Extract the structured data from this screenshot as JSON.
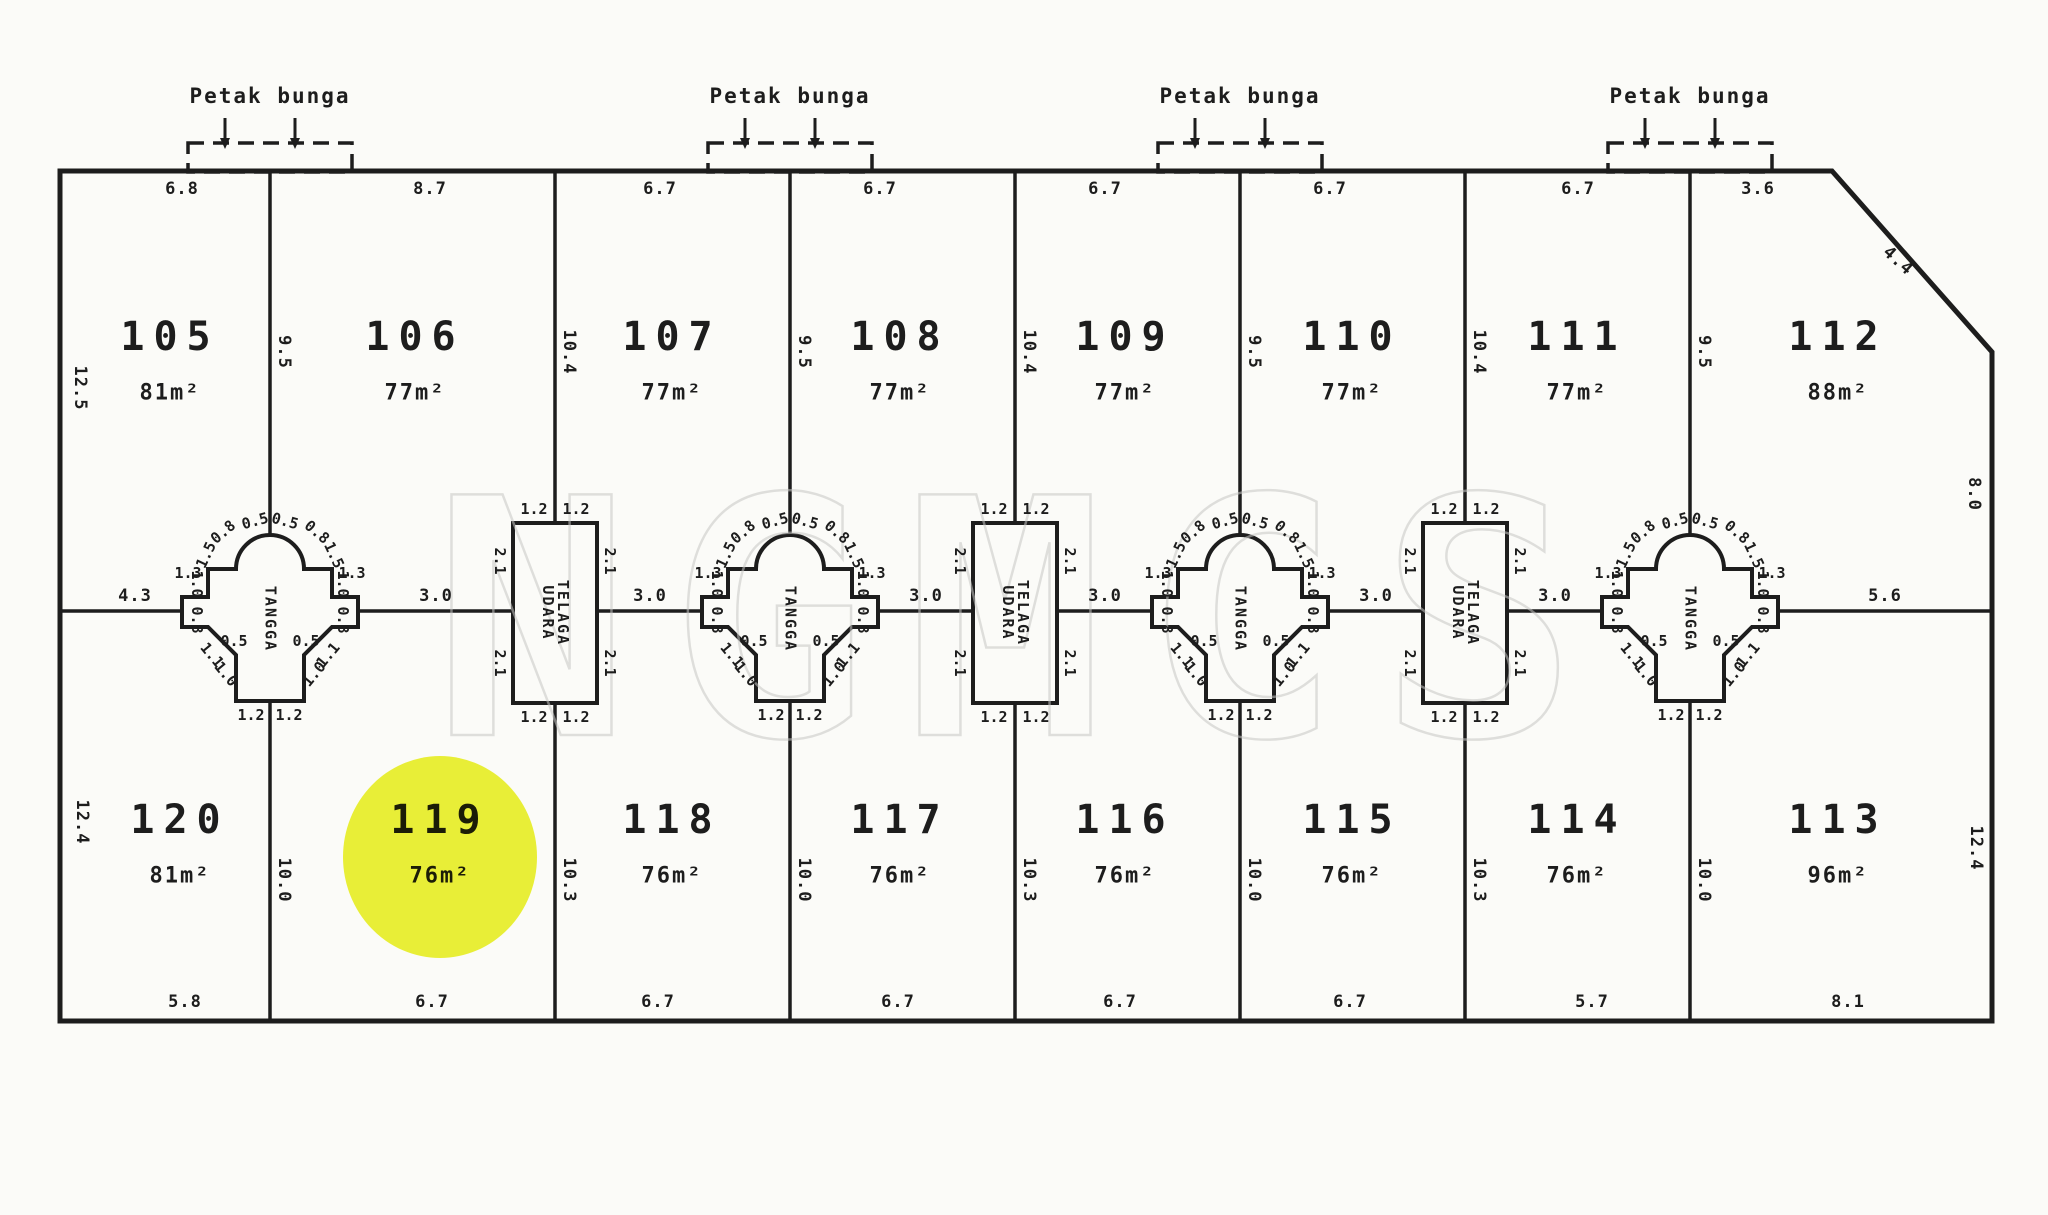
{
  "title": "Site lot plan (scanned)",
  "watermark_text": "NGMCS",
  "colors": {
    "ink": "#1d1d1d",
    "paper": "#fbfbf8",
    "watermark": "#c7c7c5",
    "highlight": "#e7ef00"
  },
  "plan": {
    "outline_points": "60,171 1832,171 1992,352 1992,1021 60,1021",
    "top_y": 171,
    "bottom_y": 1021,
    "mid_line_y": 611,
    "left_x": 60,
    "right_x": 1992,
    "divider_xs": [
      270,
      555,
      790,
      1015,
      1240,
      1465,
      1690
    ]
  },
  "flower_beds": {
    "label": "Petak bunga",
    "xs": [
      270,
      790,
      1240,
      1690
    ],
    "label_y": 96,
    "box_top": 143,
    "box_height": 29,
    "box_half_width": 82
  },
  "stairs": {
    "label": "TANGGA",
    "xs": [
      270,
      790,
      1240,
      1690
    ]
  },
  "air_wells": {
    "label_line1": "TELAGA",
    "label_line2": "UDARA",
    "xs": [
      555,
      1015,
      1465
    ]
  },
  "lots": {
    "top": [
      {
        "no": "105",
        "area": "81m²",
        "cx": 170
      },
      {
        "no": "106",
        "area": "77m²",
        "cx": 415
      },
      {
        "no": "107",
        "area": "77m²",
        "cx": 672
      },
      {
        "no": "108",
        "area": "77m²",
        "cx": 900
      },
      {
        "no": "109",
        "area": "77m²",
        "cx": 1125
      },
      {
        "no": "110",
        "area": "77m²",
        "cx": 1352
      },
      {
        "no": "111",
        "area": "77m²",
        "cx": 1577
      },
      {
        "no": "112",
        "area": "88m²",
        "cx": 1838
      }
    ],
    "bottom": [
      {
        "no": "120",
        "area": "81m²",
        "cx": 180
      },
      {
        "no": "119",
        "area": "76m²",
        "cx": 440,
        "highlighted": true
      },
      {
        "no": "118",
        "area": "76m²",
        "cx": 672
      },
      {
        "no": "117",
        "area": "76m²",
        "cx": 900
      },
      {
        "no": "116",
        "area": "76m²",
        "cx": 1125
      },
      {
        "no": "115",
        "area": "76m²",
        "cx": 1352
      },
      {
        "no": "114",
        "area": "76m²",
        "cx": 1577
      },
      {
        "no": "113",
        "area": "96m²",
        "cx": 1838
      }
    ],
    "top_no_y": 337,
    "top_area_y": 393,
    "bottom_no_y": 820,
    "bottom_area_y": 876
  },
  "dims": {
    "top_edge_y": 189,
    "top_edge": [
      {
        "t": "6.8",
        "x": 182
      },
      {
        "t": "8.7",
        "x": 430
      },
      {
        "t": "6.7",
        "x": 660
      },
      {
        "t": "6.7",
        "x": 880
      },
      {
        "t": "6.7",
        "x": 1105
      },
      {
        "t": "6.7",
        "x": 1330
      },
      {
        "t": "6.7",
        "x": 1578
      },
      {
        "t": "3.6",
        "x": 1758
      }
    ],
    "bottom_edge_y": 1002,
    "bottom_edge": [
      {
        "t": "5.8",
        "x": 185
      },
      {
        "t": "6.7",
        "x": 432
      },
      {
        "t": "6.7",
        "x": 658
      },
      {
        "t": "6.7",
        "x": 898
      },
      {
        "t": "6.7",
        "x": 1120
      },
      {
        "t": "6.7",
        "x": 1350
      },
      {
        "t": "5.7",
        "x": 1592
      },
      {
        "t": "8.1",
        "x": 1848
      }
    ],
    "upper_divider_y": 352,
    "upper_dividers": [
      "9.5",
      "10.4",
      "9.5",
      "10.4",
      "9.5",
      "10.4",
      "9.5"
    ],
    "lower_divider_y": 880,
    "lower_dividers": [
      "10.0",
      "10.3",
      "10.0",
      "10.3",
      "10.0",
      "10.3",
      "10.0"
    ],
    "mid_line_y": 596,
    "mid_line": [
      {
        "t": "4.3",
        "x": 135
      },
      {
        "t": "3.0",
        "x": 436
      },
      {
        "t": "3.0",
        "x": 650
      },
      {
        "t": "3.0",
        "x": 926
      },
      {
        "t": "3.0",
        "x": 1105
      },
      {
        "t": "3.0",
        "x": 1376
      },
      {
        "t": "3.0",
        "x": 1555
      },
      {
        "t": "5.6",
        "x": 1885
      }
    ],
    "edges": [
      {
        "t": "12.5",
        "x": 80,
        "y": 388,
        "r": 90
      },
      {
        "t": "12.4",
        "x": 82,
        "y": 822,
        "r": 90
      },
      {
        "t": "4.4",
        "x": 1898,
        "y": 261,
        "r": 42
      },
      {
        "t": "8.0",
        "x": 1974,
        "y": 494,
        "r": 90
      },
      {
        "t": "12.4",
        "x": 1976,
        "y": 848,
        "r": 90
      }
    ]
  },
  "cross_dims": [
    {
      "t": "0.5",
      "dx": -15,
      "dy": -90,
      "r": -15
    },
    {
      "t": "0.5",
      "dx": 15,
      "dy": -90,
      "r": 15
    },
    {
      "t": "0.8",
      "dx": -47,
      "dy": -79,
      "r": -40
    },
    {
      "t": "0.8",
      "dx": 47,
      "dy": -79,
      "r": 40
    },
    {
      "t": "1.5",
      "dx": -64,
      "dy": -56,
      "r": -65
    },
    {
      "t": "1.5",
      "dx": 64,
      "dy": -56,
      "r": 65
    },
    {
      "t": "1.3",
      "dx": -82,
      "dy": -38,
      "r": 0
    },
    {
      "t": "1.3",
      "dx": 82,
      "dy": -38,
      "r": 0
    },
    {
      "t": "1.0",
      "dx": -73,
      "dy": -27,
      "r": 90
    },
    {
      "t": "1.0",
      "dx": 73,
      "dy": -27,
      "r": 90
    },
    {
      "t": "0.8",
      "dx": -73,
      "dy": 9,
      "r": 90
    },
    {
      "t": "0.8",
      "dx": 73,
      "dy": 9,
      "r": 90
    },
    {
      "t": "0.5",
      "dx": -36,
      "dy": 30,
      "r": 0
    },
    {
      "t": "0.5",
      "dx": 36,
      "dy": 30,
      "r": 0
    },
    {
      "t": "1.1",
      "dx": -58,
      "dy": 44,
      "r": 50
    },
    {
      "t": "1.1",
      "dx": 58,
      "dy": 44,
      "r": -50
    },
    {
      "t": "1.0",
      "dx": -44,
      "dy": 63,
      "r": 50
    },
    {
      "t": "1.0",
      "dx": 44,
      "dy": 63,
      "r": -50
    },
    {
      "t": "1.2",
      "dx": -19,
      "dy": 104,
      "r": 0
    },
    {
      "t": "1.2",
      "dx": 19,
      "dy": 104,
      "r": 0
    }
  ],
  "rect_dims": [
    {
      "t": "1.2",
      "dx": -21,
      "dy": -102,
      "r": 0
    },
    {
      "t": "1.2",
      "dx": 21,
      "dy": -102,
      "r": 0
    },
    {
      "t": "2.1",
      "dx": -55,
      "dy": -50,
      "r": 90
    },
    {
      "t": "2.1",
      "dx": 55,
      "dy": -50,
      "r": 90
    },
    {
      "t": "2.1",
      "dx": -55,
      "dy": 52,
      "r": 90
    },
    {
      "t": "2.1",
      "dx": 55,
      "dy": 52,
      "r": 90
    },
    {
      "t": "1.2",
      "dx": -21,
      "dy": 106,
      "r": 0
    },
    {
      "t": "1.2",
      "dx": 21,
      "dy": 106,
      "r": 0
    }
  ],
  "highlight": {
    "cx": 440,
    "cy": 857,
    "rx": 97,
    "ry": 101
  }
}
